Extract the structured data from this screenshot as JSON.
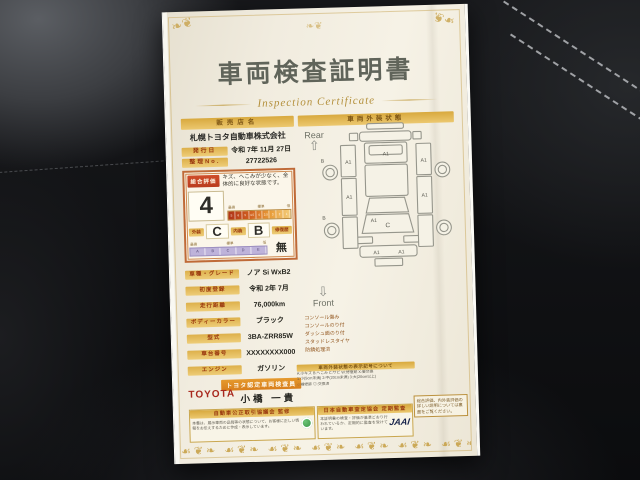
{
  "title": "車両検査証明書",
  "subtitle": "Inspection Certificate",
  "dealer": {
    "label": "販売店名",
    "value": "札幌トヨタ自動車株式会社"
  },
  "issue": {
    "label": "発行日",
    "value": "令和 7年 11月 27日"
  },
  "ref_no": {
    "label": "整理No.",
    "value": "27722526"
  },
  "evaluation": {
    "label": "総合評価",
    "grade": "4",
    "comment": "キズ、へこみが少なく、全体的に良好な状態です。",
    "scale_labels": [
      "最高",
      "標準",
      "低"
    ],
    "grade_scale": [
      "S",
      "6",
      "5",
      "4.5",
      "4",
      "3.5",
      "3",
      "2",
      "1"
    ],
    "exterior": {
      "label": "外装",
      "grade": "C"
    },
    "interior": {
      "label": "内装",
      "grade": "B"
    },
    "repair": {
      "label": "修復歴",
      "value": "無"
    },
    "letter_scale": [
      "A",
      "B",
      "C",
      "D",
      "E"
    ]
  },
  "specs": [
    {
      "label": "車種・グレード",
      "value": "ノア Si WxB2"
    },
    {
      "label": "初度登録",
      "value": "令和 2年 7月"
    },
    {
      "label": "走行距離",
      "value": "76,000km"
    },
    {
      "label": "ボディーカラー",
      "value": "ブラック"
    },
    {
      "label": "型式",
      "value": "3BA-ZRR85W"
    },
    {
      "label": "車台番号",
      "value": "XXXXXXXX000"
    },
    {
      "label": "エンジン",
      "value": "ガソリン"
    }
  ],
  "inspector": {
    "badge": "トヨタ認定車両検査員",
    "brand": "TOYOTA",
    "name": "小橋 一貴"
  },
  "statement": "当車両は、自動車オークションで適用される車両評価基準に沿い、トヨタユーゼックが認定した検査員が厳正に検査・評価いたしました。",
  "diagram": {
    "header": "車両外装状態",
    "rear_label": "Rear",
    "front_label": "Front",
    "marks": [
      "A1",
      "A1",
      "A1",
      "A1",
      "A1",
      "C",
      "A1",
      "A1",
      "A1",
      "B",
      "B"
    ],
    "notes": [
      "コンソール傷み",
      "コンソールのり付",
      "ダッシュ面のり付",
      "スタッドレスタイヤ",
      "防錆処理済"
    ]
  },
  "legend": {
    "header": "車両外装状態の表示記号について",
    "lines": [
      "A:小キズ B:へこみ C:サビ W:修復跡 X:要交換",
      "1:小(5cm未満) 2:中(20cm未満) 3:大(20cm以上)",
      "○:補修跡 ◎:交換済"
    ]
  },
  "footer": {
    "council": {
      "header": "自動車公正取引協議会 監修",
      "text": "本書は、展示車両の品質等の状態について、お客様に正しい情報をお伝えするために作成・表示しています。"
    },
    "audit": {
      "header": "日本自動車査定協会 定期監査",
      "text": "本証明書の検査・評価が基準どおり行われているか、定期的に監査を受けています。",
      "logo": "JAAI"
    },
    "note": "総合評価、内外装評価の詳しい説明については裏面をご覧ください。"
  },
  "ornament": {
    "corner": "❧❦",
    "band": "☙❦❧ ☙❦❧ ☙❦❧ ☙❦❧ ☙❦❧ ☙❦❧ ☙❦❧ ☙❦❧"
  }
}
